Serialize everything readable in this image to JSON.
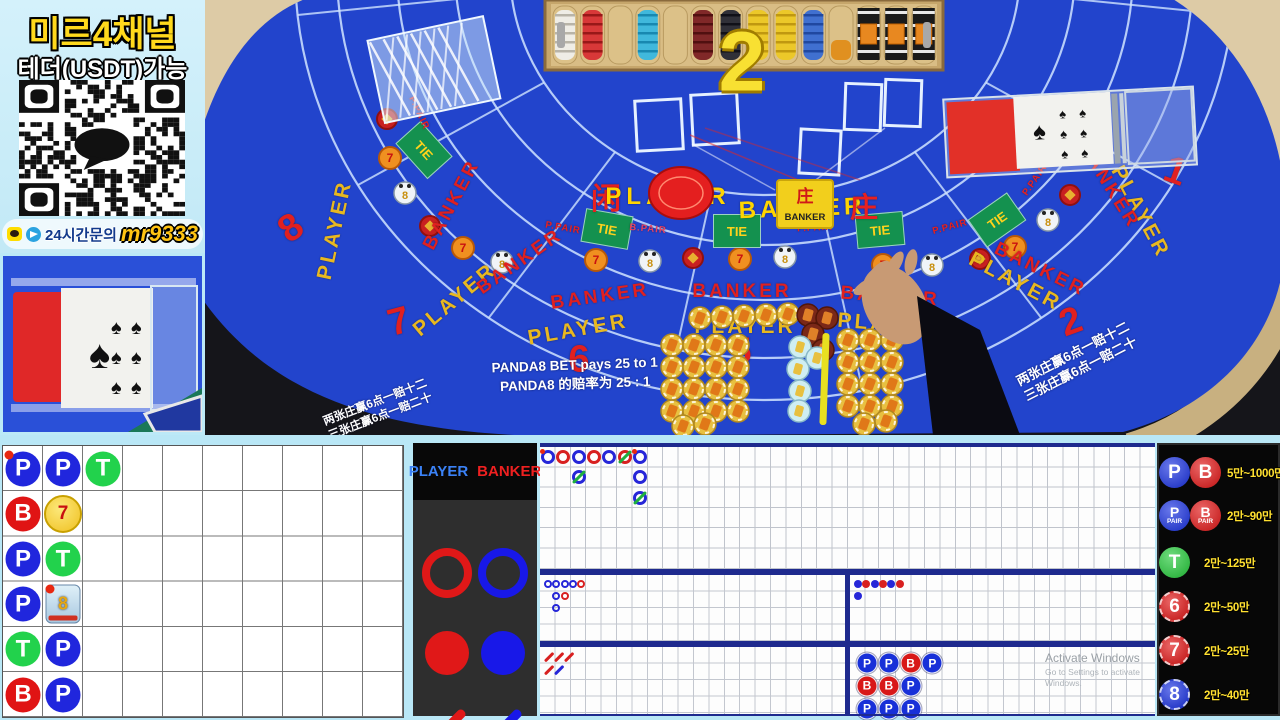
{
  "sidebar": {
    "title": "미르4채널",
    "subtitle": "테더(USDT)가능",
    "contact_prefix": "24시간문의",
    "contact_id": "mr9333"
  },
  "table": {
    "big_number": "2",
    "seats": [
      "8",
      "7",
      "6",
      "5",
      "2",
      "1"
    ],
    "labels": {
      "player": "PLAYER",
      "banker": "BANKER",
      "tie": "TIE",
      "ppair": "P.PAIR",
      "bpair": "B.PAIR",
      "player_cn": "闲",
      "banker_cn": "庄"
    },
    "plaque": {
      "cn": "庄",
      "en": "BANKER"
    },
    "notices": {
      "panda_en": "PANDA8 BET pays 25 to 1",
      "panda_cn": "PANDA8 的赔率为 25 : 1",
      "forty_en": "s 40 to 1",
      "forty_cn": "为 40 : 1",
      "super6_line1": "两张庄赢6点一赔十二",
      "super6_line2": "三张庄赢6点一赔二十"
    }
  },
  "roads": {
    "letters": {
      "P": "P",
      "B": "B",
      "T": "T",
      "F7": "7",
      "P8": "8"
    },
    "bead": {
      "rows": 6,
      "cols": 10,
      "entries": [
        {
          "r": 1,
          "c": 1,
          "k": "P",
          "dot": true
        },
        {
          "r": 2,
          "c": 1,
          "k": "B"
        },
        {
          "r": 3,
          "c": 1,
          "k": "P"
        },
        {
          "r": 4,
          "c": 1,
          "k": "P"
        },
        {
          "r": 5,
          "c": 1,
          "k": "T"
        },
        {
          "r": 6,
          "c": 1,
          "k": "B"
        },
        {
          "r": 1,
          "c": 2,
          "k": "P"
        },
        {
          "r": 2,
          "c": 2,
          "k": "F7"
        },
        {
          "r": 3,
          "c": 2,
          "k": "T"
        },
        {
          "r": 4,
          "c": 2,
          "k": "P8",
          "dot": true
        },
        {
          "r": 5,
          "c": 2,
          "k": "P"
        },
        {
          "r": 6,
          "c": 2,
          "k": "P"
        },
        {
          "r": 1,
          "c": 3,
          "k": "T"
        }
      ]
    },
    "big_road": {
      "entries": [
        {
          "c": 1,
          "r": 1,
          "k": "P",
          "dot": true
        },
        {
          "c": 2,
          "r": 1,
          "k": "B"
        },
        {
          "c": 3,
          "r": 1,
          "k": "P"
        },
        {
          "c": 3,
          "r": 2,
          "k": "P",
          "tie": true
        },
        {
          "c": 4,
          "r": 1,
          "k": "B"
        },
        {
          "c": 5,
          "r": 1,
          "k": "P"
        },
        {
          "c": 6,
          "r": 1,
          "k": "B",
          "tie": true
        },
        {
          "c": 7,
          "r": 1,
          "k": "P",
          "dot": true
        },
        {
          "c": 7,
          "r": 2,
          "k": "P"
        },
        {
          "c": 7,
          "r": 3,
          "k": "P",
          "tie": true
        }
      ]
    },
    "big_eye": {
      "entries": [
        {
          "c": 1,
          "r": 1,
          "col": "blue"
        },
        {
          "c": 2,
          "r": 1,
          "col": "blue"
        },
        {
          "c": 3,
          "r": 1,
          "col": "blue"
        },
        {
          "c": 4,
          "r": 1,
          "col": "blue"
        },
        {
          "c": 5,
          "r": 1,
          "col": "red"
        },
        {
          "c": 2,
          "r": 2,
          "col": "blue"
        },
        {
          "c": 3,
          "r": 2,
          "col": "red"
        },
        {
          "c": 2,
          "r": 3,
          "col": "blue"
        }
      ]
    },
    "small": {
      "entries": [
        {
          "c": 1,
          "r": 1,
          "col": "blue"
        },
        {
          "c": 2,
          "r": 1,
          "col": "red"
        },
        {
          "c": 3,
          "r": 1,
          "col": "blue"
        },
        {
          "c": 4,
          "r": 1,
          "col": "red"
        },
        {
          "c": 5,
          "r": 1,
          "col": "blue"
        },
        {
          "c": 6,
          "r": 1,
          "col": "red"
        },
        {
          "c": 1,
          "r": 2,
          "col": "blue"
        }
      ]
    },
    "cockroach": {
      "entries": [
        {
          "c": 1,
          "r": 1,
          "col": "red"
        },
        {
          "c": 2,
          "r": 1,
          "col": "red"
        },
        {
          "c": 3,
          "r": 1,
          "col": "red"
        },
        {
          "c": 1,
          "r": 2,
          "col": "red"
        },
        {
          "c": 2,
          "r": 2,
          "col": "blue"
        }
      ]
    },
    "summary": {
      "entries": [
        {
          "c": 1,
          "r": 1,
          "k": "P"
        },
        {
          "c": 2,
          "r": 1,
          "k": "P"
        },
        {
          "c": 3,
          "r": 1,
          "k": "B"
        },
        {
          "c": 4,
          "r": 1,
          "k": "P"
        },
        {
          "c": 1,
          "r": 2,
          "k": "B"
        },
        {
          "c": 2,
          "r": 2,
          "k": "B"
        },
        {
          "c": 3,
          "r": 2,
          "k": "P"
        },
        {
          "c": 1,
          "r": 3,
          "k": "P"
        },
        {
          "c": 2,
          "r": 3,
          "k": "P"
        },
        {
          "c": 3,
          "r": 3,
          "k": "P"
        }
      ]
    }
  },
  "legend": {
    "player": "PLAYER",
    "banker": "BANKER"
  },
  "limits": {
    "rows": [
      {
        "icons": [
          {
            "t": "P",
            "c": "blue"
          },
          {
            "t": "B",
            "c": "red"
          }
        ],
        "range": "5만~1000만"
      },
      {
        "icons": [
          {
            "t": "P",
            "sub": "PAIR",
            "c": "blue"
          },
          {
            "t": "B",
            "sub": "PAIR",
            "c": "red"
          }
        ],
        "range": "2만~90만"
      },
      {
        "icons": [
          {
            "t": "T",
            "c": "green"
          }
        ],
        "range": "2만~125만"
      },
      {
        "icons": [
          {
            "t": "6",
            "c": "red",
            "coin": true
          }
        ],
        "range": "2만~50만"
      },
      {
        "icons": [
          {
            "t": "7",
            "c": "red",
            "coin": true
          }
        ],
        "range": "2만~25만"
      },
      {
        "icons": [
          {
            "t": "8",
            "c": "blue",
            "coin": true
          }
        ],
        "range": "2만~40만"
      }
    ]
  },
  "watermark": {
    "line1": "Activate Windows",
    "line2": "Go to Settings to activate Windows."
  },
  "colors": {
    "player_blue": "#2026dd",
    "banker_red": "#e01414",
    "tie_green": "#22d24c",
    "gold": "#ffd71e",
    "navy": "#1e2a8e",
    "frame": "#b9e7f6",
    "felt": "#2244cc"
  }
}
